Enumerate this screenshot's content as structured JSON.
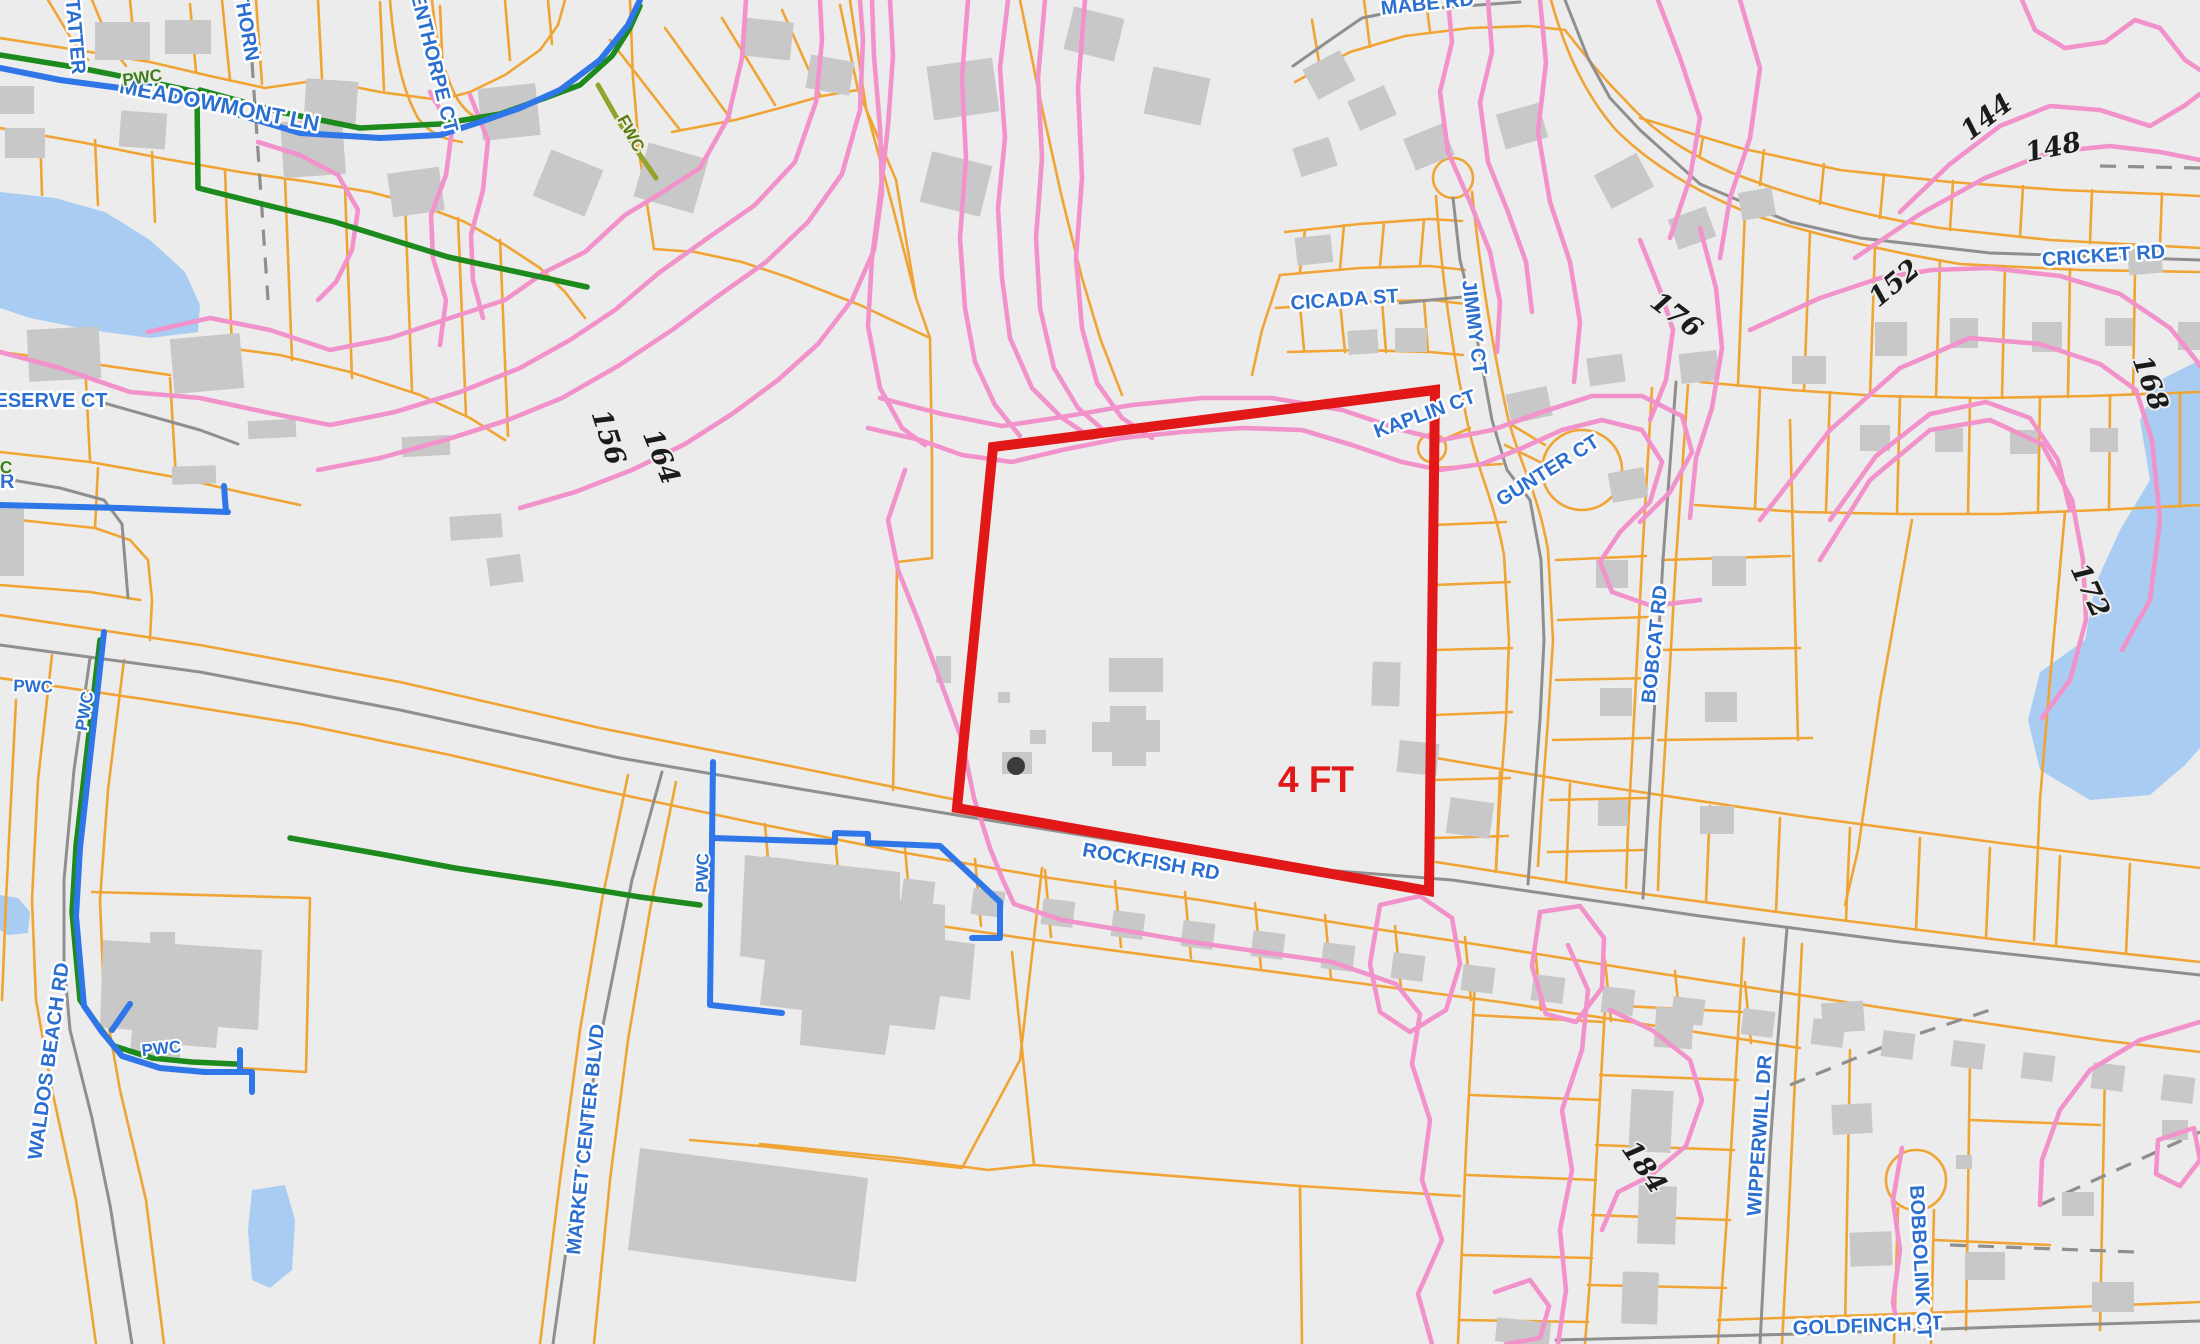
{
  "map": {
    "background_color": "#ececec",
    "highlight": {
      "label": "4 FT",
      "color": "#e21717"
    },
    "legend_colors": {
      "parcel_lines": "#f0a434",
      "contour_lines": "#f292cb",
      "roads": "#8f8f8f",
      "street_labels": "#2b6fd0",
      "water_fill": "#a9cdf2",
      "buildings": "#c8c8c8",
      "water_utility_line": "#2f76e8",
      "sewer_utility_line": "#1d8a1d",
      "highlight_outline": "#e21717"
    },
    "street_labels": {
      "tatter": {
        "text": "TATTER"
      },
      "thorn": {
        "text": "THORN"
      },
      "enthorpe_ct": {
        "text": "ENTHORPE CT"
      },
      "meadowmont_ln": {
        "text": "MEADOWMONT LN"
      },
      "mabe_rd": {
        "text": "MABE RD"
      },
      "cicada_st": {
        "text": "CICADA ST"
      },
      "jimmy_ct": {
        "text": "JIMMY CT"
      },
      "kaplin_ct": {
        "text": "KAPLIN CT"
      },
      "gunter_ct": {
        "text": "GUNTER CT"
      },
      "cricket_rd": {
        "text": "CRICKET RD"
      },
      "bobcat_rd": {
        "text": "BOBCAT RD"
      },
      "rockfish_rd": {
        "text": "ROCKFISH RD"
      },
      "reserve_ct": {
        "text": "ESERVE CT"
      },
      "dr_partial": {
        "text": "DR"
      },
      "waldos_beach_rd": {
        "text": "WALDOS BEACH RD"
      },
      "market_center_blvd": {
        "text": "MARKET CENTER BLVD"
      },
      "wipperwill_dr": {
        "text": "WIPPERWILL DR"
      },
      "goldfinch_st": {
        "text": "GOLDFINCH ST"
      },
      "bobbolink_ct": {
        "text": "BOBBOLINK CT"
      }
    },
    "utility_labels": {
      "pwc_creek": {
        "text": "PWC"
      },
      "fwc_creek": {
        "text": "FWC"
      },
      "pwc_left": {
        "text": "PWC"
      },
      "pwc_left_vertical": {
        "text": "PWC"
      },
      "pwc_edge": {
        "text": "PWC"
      },
      "pwc_factory": {
        "text": "PWC"
      },
      "pwc_school": {
        "text": "PWC"
      }
    },
    "contour_labels": {
      "c144": {
        "text": "144"
      },
      "c148": {
        "text": "148"
      },
      "c152": {
        "text": "152"
      },
      "c156": {
        "text": "156"
      },
      "c164": {
        "text": "164"
      },
      "c168": {
        "text": "168"
      },
      "c172": {
        "text": "172"
      },
      "c176": {
        "text": "176"
      },
      "c184": {
        "text": "184"
      }
    }
  }
}
